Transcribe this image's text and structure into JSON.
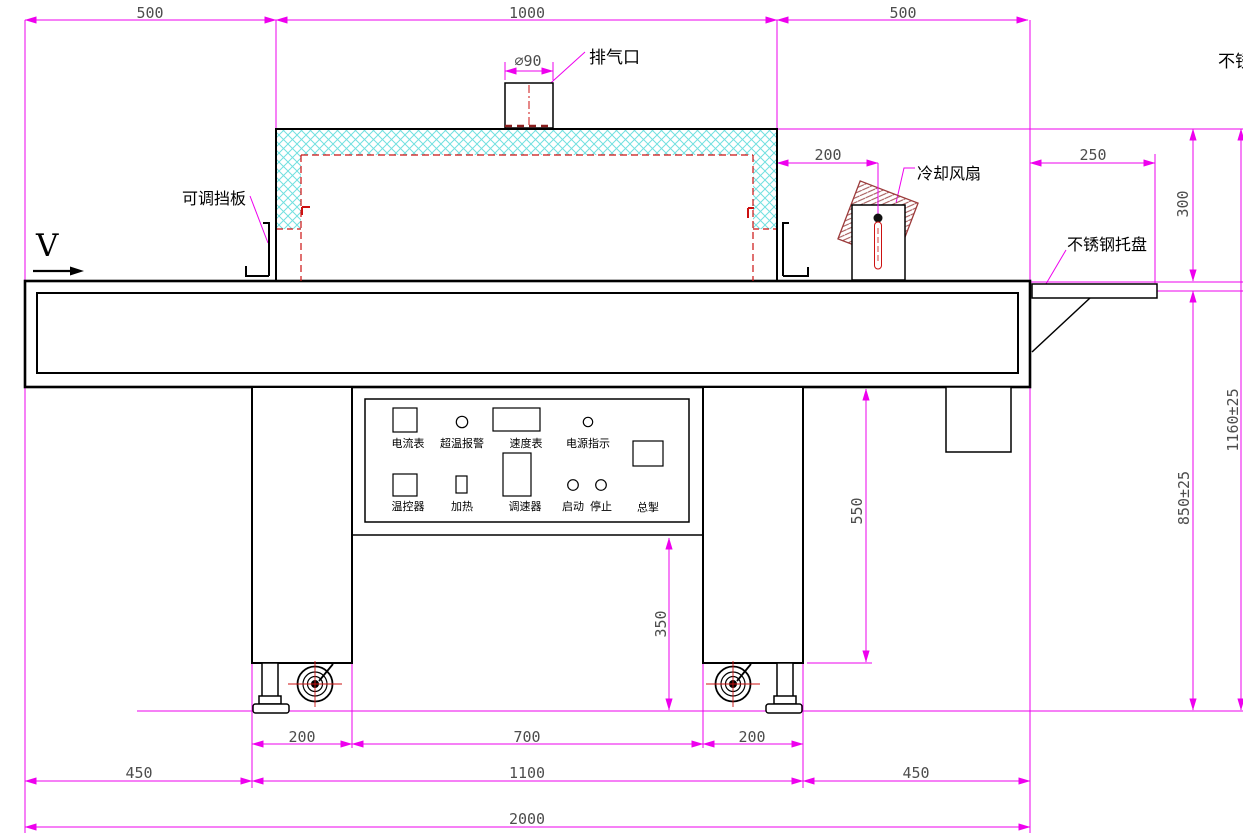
{
  "drawing": {
    "dimensions": {
      "top_left": "500",
      "top_center": "1000",
      "top_right": "500",
      "exhaust_diameter": "∅90",
      "fan_offset": "200",
      "tray_length": "250",
      "outlet_height": "300",
      "work_height": "850±25",
      "total_height": "1160±25",
      "table_to_floor": "550",
      "panel_to_floor": "350",
      "left_leg_width": "200",
      "leg_gap": "700",
      "right_leg_width": "200",
      "left_overhang": "450",
      "leg_span": "1100",
      "right_overhang": "450",
      "total_length": "2000"
    },
    "callouts": {
      "exhaust_port": "排气口",
      "adjustable_baffle": "可调挡板",
      "cooling_fan": "冷却风扇",
      "stainless_steel_tray": "不锈钢托盘",
      "top_right_clipped": "不锈钢网带",
      "belt_direction": "V"
    },
    "control_panel": {
      "ammeter": "电流表",
      "overtemp_alarm": "超温报警",
      "speed_meter": "速度表",
      "power_indicator": "电源指示",
      "temp_controller": "温控器",
      "heating": "加热",
      "speed_regulator": "调速器",
      "start": "启动",
      "stop": "停止",
      "main_switch": "总掣"
    },
    "colors": {
      "dimension": "#ee00ee",
      "centerline": "#cc1111",
      "insulation": "#72e0e0"
    }
  }
}
